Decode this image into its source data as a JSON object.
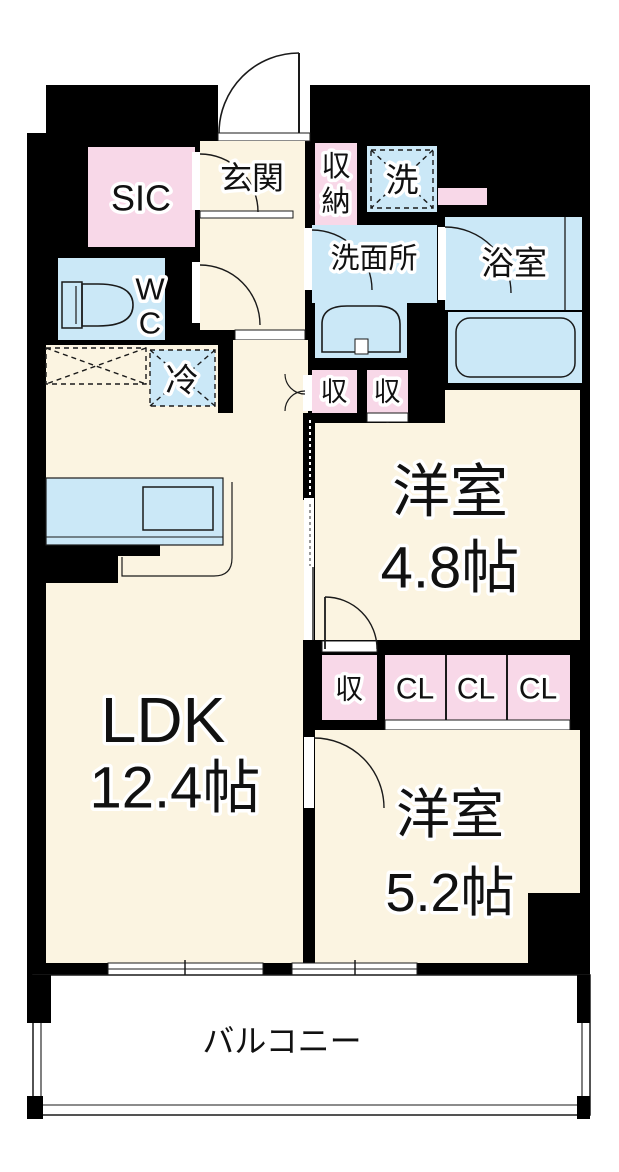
{
  "plan": {
    "colors": {
      "wall": "#000000",
      "floor": "#FBF4E1",
      "wet_area": "#CBE8F7",
      "storage": "#F8D8E8",
      "balcony": "#FFFFFF"
    },
    "rooms": {
      "entrance": {
        "label": "玄関"
      },
      "sic": {
        "label": "SIC"
      },
      "shoes_storage": {
        "label": "収納"
      },
      "washer": {
        "label": "洗"
      },
      "washroom": {
        "label": "洗面所"
      },
      "bathroom": {
        "label": "浴室"
      },
      "wc": {
        "label": "WC"
      },
      "fridge": {
        "label": "冷"
      },
      "hall_storage_left": {
        "label": "収"
      },
      "hall_storage_right": {
        "label": "収"
      },
      "western_room_1": {
        "label": "洋室",
        "size": "4.8帖"
      },
      "ldk": {
        "label": "LDK",
        "size": "12.4帖"
      },
      "room_storage": {
        "label": "収"
      },
      "closets": [
        "CL",
        "CL",
        "CL"
      ],
      "western_room_2": {
        "label": "洋室",
        "size": "5.2帖"
      },
      "balcony": {
        "label": "バルコニー"
      }
    }
  }
}
